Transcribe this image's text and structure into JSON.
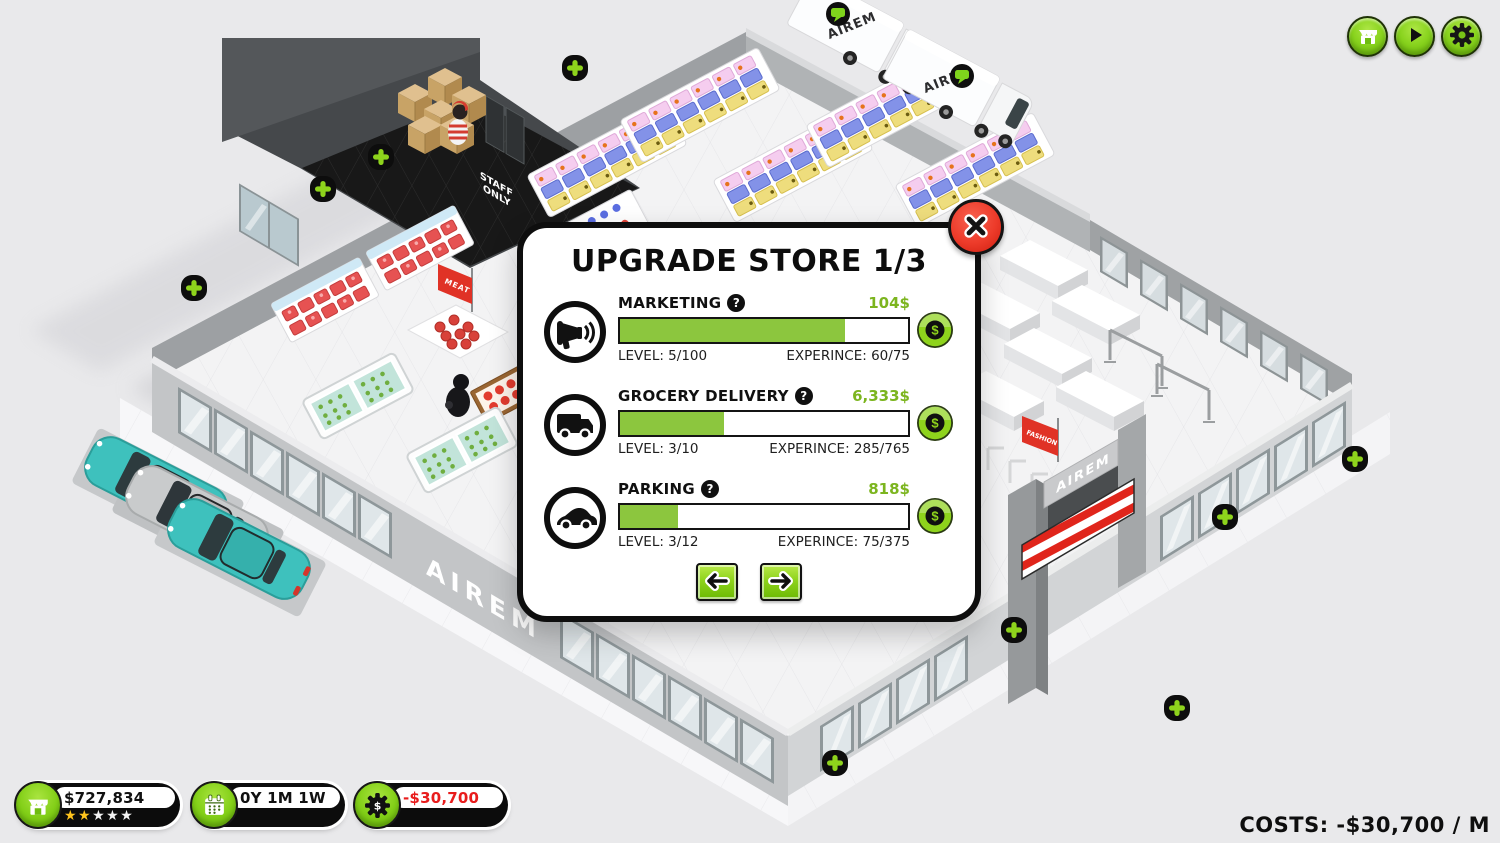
{
  "modal": {
    "title": "UPGRADE STORE 1/3",
    "upgrades": [
      {
        "name": "MARKETING",
        "help": "?",
        "cost": "104$",
        "level": "LEVEL: 5/100",
        "experience": "EXPERINCE: 60/75",
        "progress_pct": 78,
        "icon": "megaphone-icon"
      },
      {
        "name": "GROCERY DELIVERY",
        "help": "?",
        "cost": "6,333$",
        "level": "LEVEL: 3/10",
        "experience": "EXPERINCE: 285/765",
        "progress_pct": 36,
        "icon": "delivery-truck-icon"
      },
      {
        "name": "PARKING",
        "help": "?",
        "cost": "818$",
        "level": "LEVEL: 3/12",
        "experience": "EXPERINCE: 75/375",
        "progress_pct": 20,
        "icon": "car-icon"
      }
    ]
  },
  "status": {
    "money": "$727,834",
    "stars_gold": "★★",
    "stars_blank": "★★★",
    "date": "0Y 1M 1W",
    "expenses": "-$30,700",
    "costs_label": "COSTS: -$30,700 / M"
  },
  "scene": {
    "store_name": "AIREM",
    "entrance_sign": "AIREM",
    "truck_brand": "AIREM",
    "staff_line1": "STAFF",
    "staff_line2": "ONLY",
    "meat_sign": "MEAT",
    "fashion_sign": "FASHION"
  },
  "colors": {
    "accent_green": "#8cc63e",
    "cost_green": "#7cb51f",
    "negative_red": "#e81c1c",
    "close_red": "#ed3b2a"
  }
}
